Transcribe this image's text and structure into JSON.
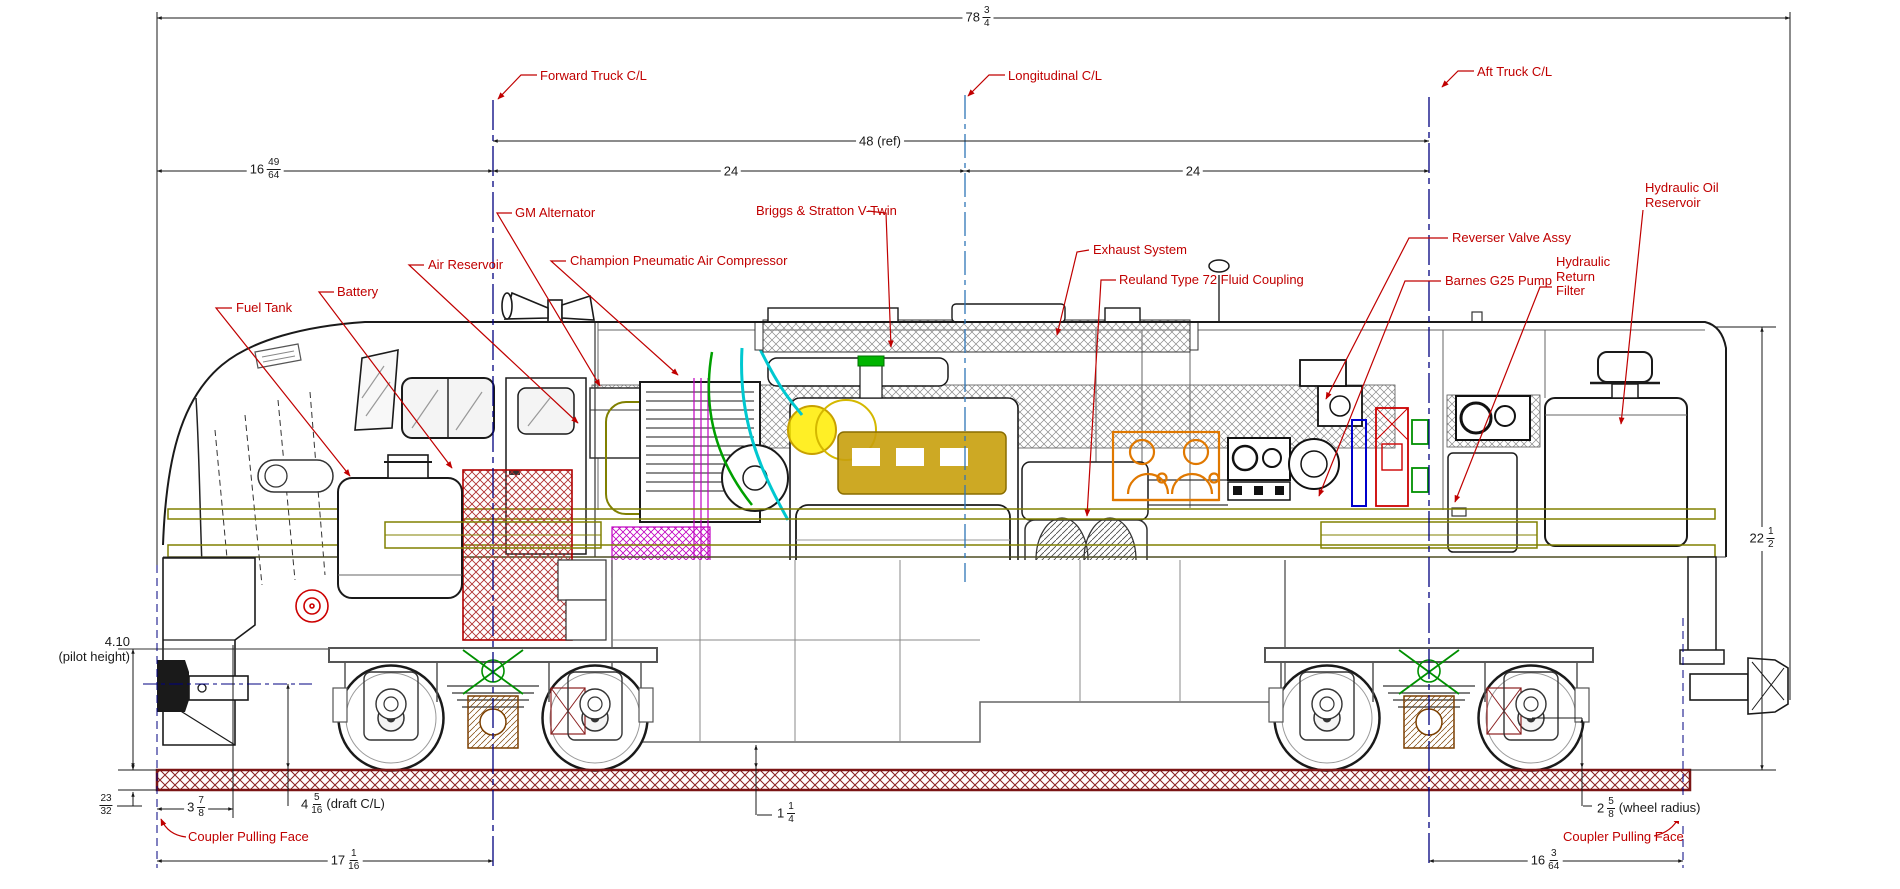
{
  "drawing": {
    "type": "locomotive side elevation cutaway",
    "callouts": {
      "forward_truck_cl": "Forward Truck C/L",
      "longitudinal_cl": "Longitudinal C/L",
      "aft_truck_cl": "Aft Truck C/L",
      "fuel_tank": "Fuel Tank",
      "battery": "Battery",
      "air_reservoir": "Air Reservoir",
      "gm_alternator": "GM Alternator",
      "champion_compressor": "Champion Pneumatic Air Compressor",
      "briggs_stratton": "Briggs & Stratton V-Twin",
      "exhaust_system": "Exhaust System",
      "reuland_coupling": "Reuland Type 72 Fluid Coupling",
      "reverser_valve": "Reverser Valve Assy",
      "barnes_pump": "Barnes G25 Pump",
      "hydraulic_return_filter": {
        "line1": "Hydraulic",
        "line2": "Return",
        "line3": "Filter"
      },
      "hydraulic_oil_reservoir": {
        "line1": "Hydraulic Oil",
        "line2": "Reservoir"
      },
      "coupler_pulling_face_front": "Coupler Pulling Face",
      "coupler_pulling_face_rear": "Coupler Pulling Face"
    },
    "dimensions": {
      "overall_length": {
        "whole": "78",
        "num": "3",
        "den": "4"
      },
      "truck_centers_ref": {
        "label": "48 (ref)"
      },
      "forward_half": {
        "label": "24"
      },
      "aft_half": {
        "label": "24"
      },
      "coupler_to_forward_truck": {
        "whole": "16",
        "num": "49",
        "den": "64"
      },
      "pilot_height": {
        "value": "4.10",
        "note": "(pilot height)"
      },
      "rail_height": {
        "num": "23",
        "den": "32"
      },
      "coupler_overhang": {
        "whole": "3",
        "num": "7",
        "den": "8"
      },
      "draft_centerline": {
        "whole": "4",
        "num": "5",
        "den": "16",
        "note": "(draft C/L)"
      },
      "underframe_clearance": {
        "whole": "1",
        "num": "1",
        "den": "4"
      },
      "front_truck_to_coupler": {
        "whole": "17",
        "num": "1",
        "den": "16"
      },
      "aft_truck_to_coupler": {
        "whole": "16",
        "num": "3",
        "den": "64"
      },
      "wheel_radius": {
        "whole": "2",
        "num": "5",
        "den": "8",
        "note": "(wheel radius)"
      },
      "overall_height": {
        "whole": "22",
        "num": "1",
        "den": "2"
      }
    },
    "colors": {
      "callout_red": "#c00000",
      "truck_centerline_navy": "#000080",
      "longitudinal_centerline_blue": "#2e75b6",
      "rail_maroon": "#8b2020",
      "frame_olive": "#808000",
      "battery_red": "#b03030",
      "engine_gold": "#c8a00c",
      "manifold_orange": "#e07800",
      "hose_cyan": "#00c8d0",
      "hose_green": "#00a000",
      "detail_magenta": "#c000c0",
      "truck_green": "#009000"
    }
  }
}
